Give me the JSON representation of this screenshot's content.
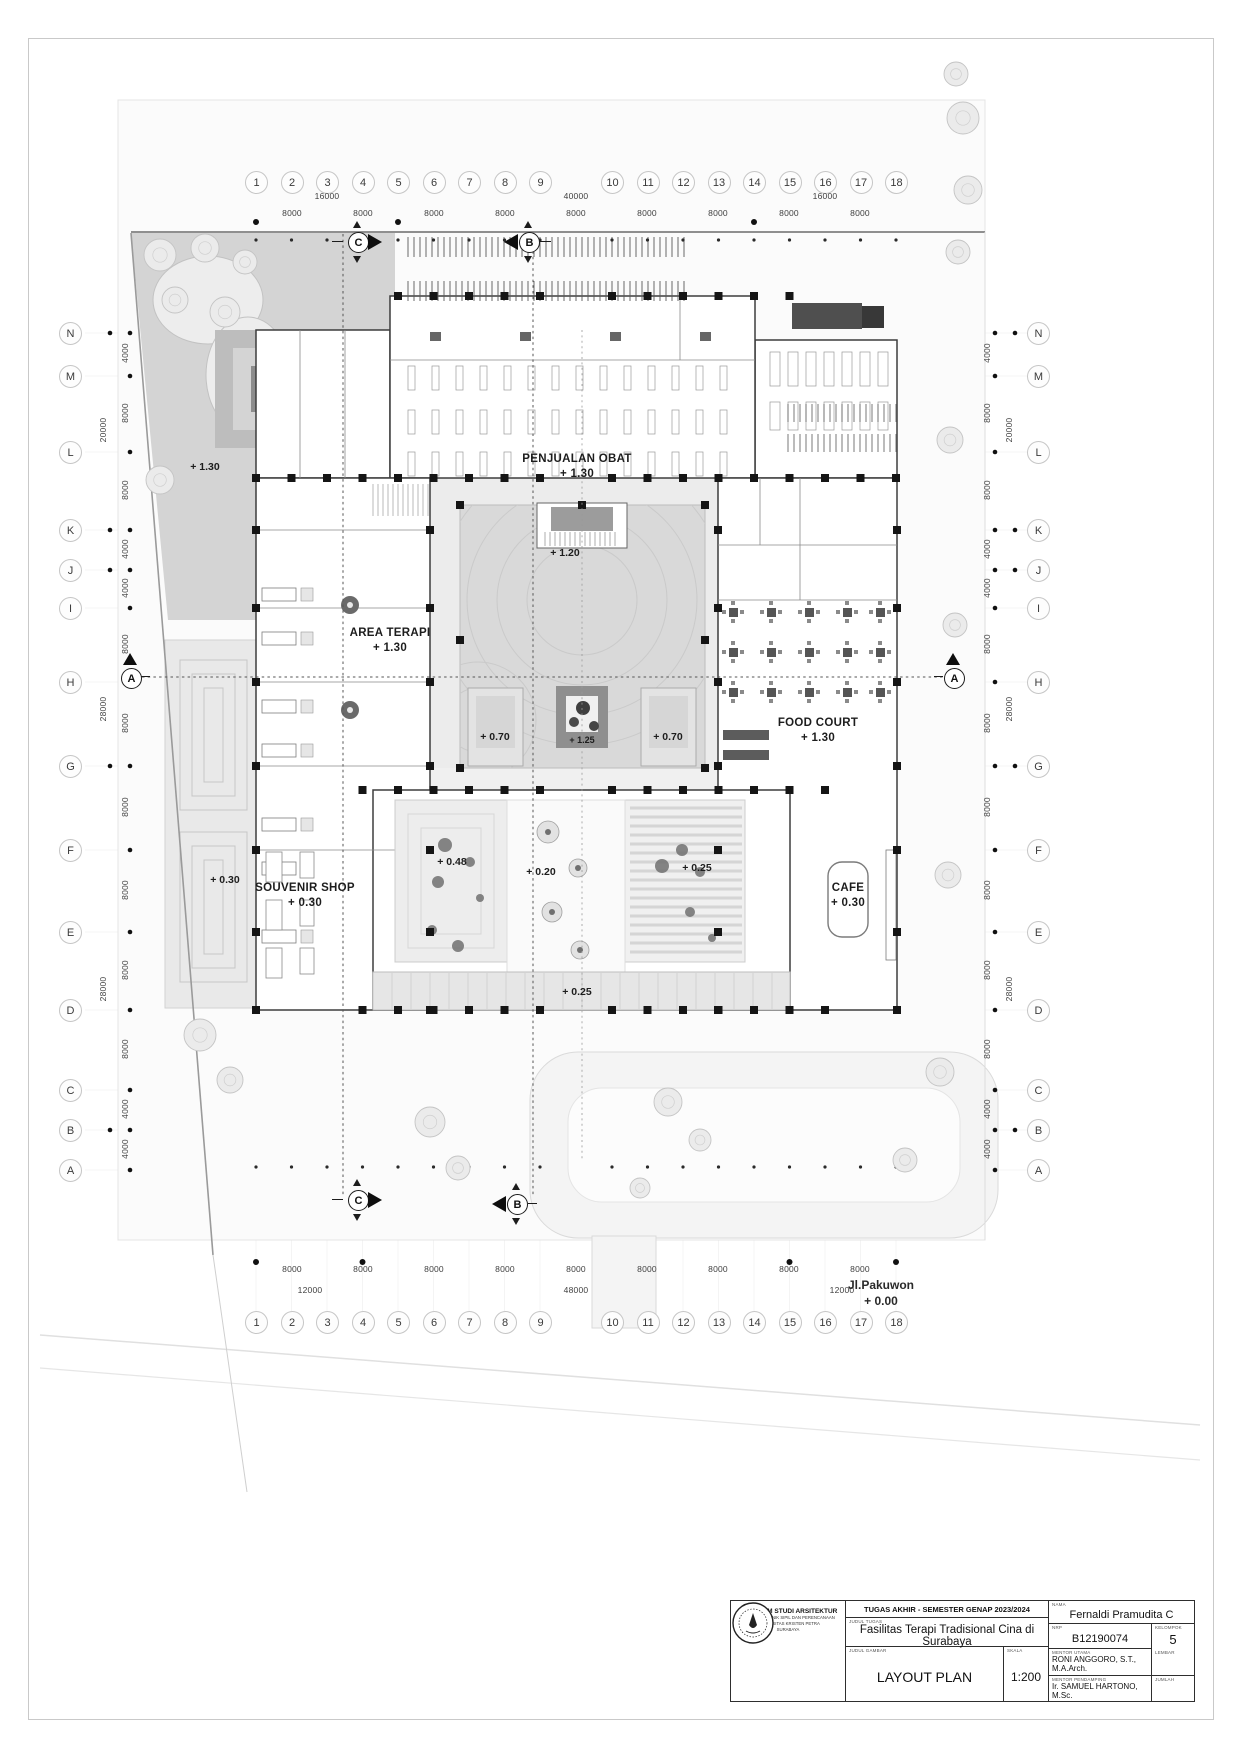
{
  "grid": {
    "top_numbers": [
      "1",
      "2",
      "3",
      "4",
      "5",
      "6",
      "7",
      "8",
      "9",
      "10",
      "11",
      "12",
      "13",
      "14",
      "15",
      "16",
      "17",
      "18"
    ],
    "left_letters": [
      "N",
      "M",
      "L",
      "K",
      "J",
      "I",
      "H",
      "G",
      "F",
      "E",
      "D",
      "C",
      "B",
      "A"
    ],
    "top_dims_major": [
      "16000",
      "40000",
      "16000"
    ],
    "top_dims_minor": [
      "8000",
      "8000",
      "8000",
      "8000",
      "8000",
      "8000",
      "8000",
      "8000",
      "8000"
    ],
    "bottom_dims_major": [
      "12000",
      "48000",
      "12000"
    ],
    "bottom_dims_minor": [
      "8000",
      "8000",
      "8000",
      "8000",
      "8000",
      "8000",
      "8000",
      "8000",
      "8000"
    ],
    "side_dims_minor": [
      "4000",
      "8000",
      "8000",
      "4000",
      "4000",
      "8000",
      "8000",
      "8000",
      "8000",
      "8000",
      "8000",
      "4000",
      "4000"
    ],
    "side_dims_major": [
      "20000",
      "28000",
      "28000"
    ]
  },
  "sections": {
    "a": "A",
    "b": "B",
    "c": "C"
  },
  "rooms": {
    "penjualan_obat": {
      "name": "PENJUALAN OBAT",
      "level": "+ 1.30"
    },
    "area_terapi": {
      "name": "AREA TERAPI",
      "level": "+ 1.30"
    },
    "food_court": {
      "name": "FOOD COURT",
      "level": "+ 1.30"
    },
    "souvenir_shop": {
      "name": "SOUVENIR SHOP",
      "level": "+ 0.30"
    },
    "cafe": {
      "name": "CAFE",
      "level": "+ 0.30"
    }
  },
  "levels": {
    "garden_northwest": "+ 1.30",
    "entry_plaza": "+ 1.20",
    "planter_left": "+ 0.70",
    "planter_right": "+ 0.70",
    "center_planter": "+ 1.25",
    "garden_west": "+ 0.30",
    "ramp": "+ 0.20",
    "garden_south_left": "+ 0.48",
    "garden_south_right": "+ 0.25",
    "south_walkway": "+ 0.25"
  },
  "road": {
    "name": "Jl.Pakuwon",
    "level": "+ 0.00"
  },
  "titleblock": {
    "institute": {
      "program": "PROGRAM STUDI ARSITEKTUR",
      "faculty": "FAKULTAS TEKNIK SIPIL DAN PERENCANAAN",
      "university": "UNIVERSITAS KRISTEN PETRA",
      "city": "SURABAYA"
    },
    "header": "TUGAS AKHIR - SEMESTER GENAP 2023/2024",
    "judul_tugas_label": "JUDUL TUGAS",
    "judul_tugas": "Fasilitas Terapi Tradisional Cina di Surabaya",
    "judul_gambar_label": "JUDUL GAMBAR",
    "judul_gambar": "LAYOUT PLAN",
    "skala_label": "SKALA",
    "skala": "1:200",
    "nama_label": "NAMA",
    "nama": "Fernaldi Pramudita C",
    "nrp_label": "NRP",
    "nrp": "B12190074",
    "kelompok_label": "KELOMPOK",
    "kelompok": "5",
    "mentor_utama_label": "MENTOR UTAMA",
    "mentor_utama": "RONI ANGGORO, S.T., M.A.Arch.",
    "mentor_pendamping_label": "MENTOR PENDAMPING",
    "mentor_pendamping": "Ir. SAMUEL HARTONO, M.Sc.",
    "lembar_label": "LEMBAR",
    "jumlah_label": "JUMLAH"
  }
}
